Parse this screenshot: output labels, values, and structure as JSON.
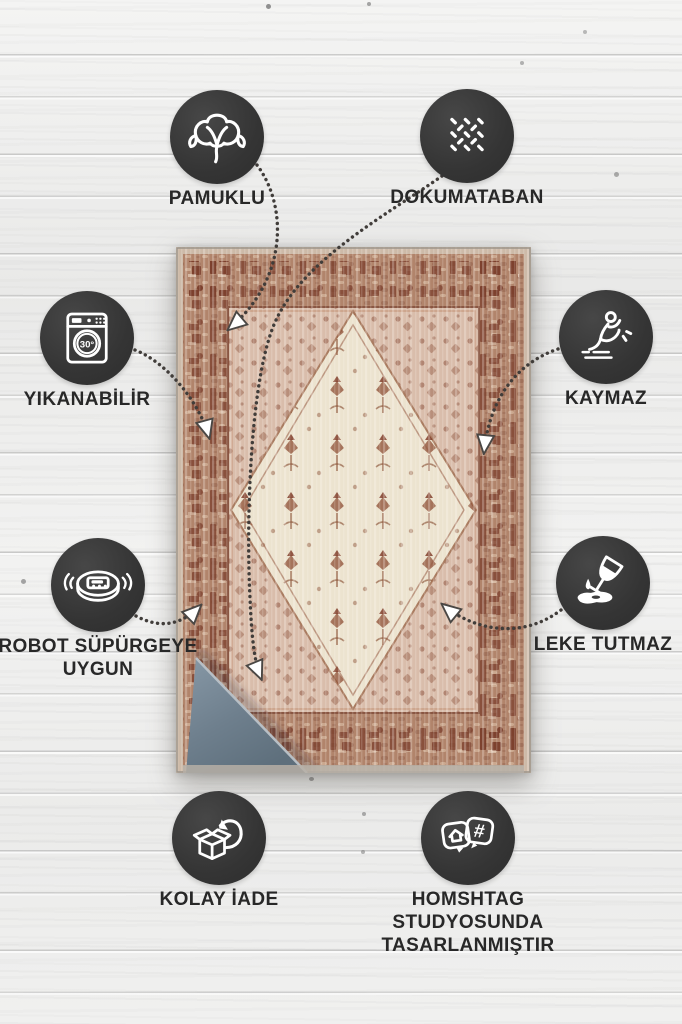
{
  "page": {
    "kind": "rug-product-feature-infographic",
    "language": "tr"
  },
  "badges": [
    {
      "id": "pamuklu",
      "label": "PAMUKLU",
      "icon": "cotton-icon"
    },
    {
      "id": "dokumataban",
      "label": "DOKUMATABAN",
      "icon": "woven-base-icon"
    },
    {
      "id": "yikanabilir",
      "label": "YIKANABİLİR",
      "icon": "washing-machine-icon",
      "icon_text": "30°"
    },
    {
      "id": "kaymaz",
      "label": "KAYMAZ",
      "icon": "anti-slip-icon"
    },
    {
      "id": "robot-supurgeye-uygun",
      "label": "ROBOT SÜPÜRGEYE UYGUN",
      "icon": "robot-vacuum-icon"
    },
    {
      "id": "leke-tutmaz",
      "label": "LEKE TUTMAZ",
      "icon": "stain-proof-icon"
    },
    {
      "id": "kolay-iade",
      "label": "KOLAY İADE",
      "icon": "easy-return-icon"
    },
    {
      "id": "homshtag",
      "label": "HOMSHTAG STUDYOSUNDA TASARLANMIŞTIR",
      "icon": "design-studio-icon",
      "icon_text": "#"
    }
  ],
  "colors": {
    "badge_circle": "#363636",
    "badge_icon": "#ffffff",
    "label_text": "#282828",
    "connector": "#413d3a",
    "arrowhead": "#ffffff",
    "wood_background": "#efefee",
    "rug_binding": "#cdbaa8",
    "rug_border": "#b1846b",
    "rug_border_motif": "#7a3e2d",
    "rug_field": "#d9bdab",
    "rug_medallion": "#ece3cf",
    "rug_backing_blue": "#73828f"
  }
}
